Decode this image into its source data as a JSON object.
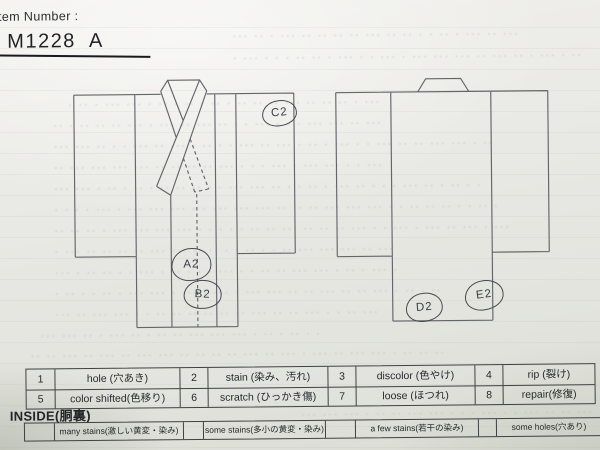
{
  "header": {
    "item_number_label": "tem Number :",
    "item_number_value": "M1228  A"
  },
  "diagram": {
    "marks": [
      {
        "id": "mark-c2",
        "label": "C2"
      },
      {
        "id": "mark-a2",
        "label": "A2"
      },
      {
        "id": "mark-b2",
        "label": "B2"
      },
      {
        "id": "mark-d2",
        "label": "D2"
      },
      {
        "id": "mark-e2",
        "label": "E2"
      }
    ]
  },
  "legend_table": {
    "rows": [
      [
        {
          "num": "1",
          "label": "hole (穴あき)"
        },
        {
          "num": "2",
          "label": "stain (染み、汚れ)"
        },
        {
          "num": "3",
          "label": "discolor (色やけ)"
        },
        {
          "num": "4",
          "label": "rip (裂け)"
        }
      ],
      [
        {
          "num": "5",
          "label": "color shifted(色移り)"
        },
        {
          "num": "6",
          "label": "scratch (ひっかき傷)"
        },
        {
          "num": "7",
          "label": "loose (ほつれ)"
        },
        {
          "num": "8",
          "label": "repair(修復)"
        }
      ]
    ]
  },
  "inside_section": {
    "title": "INSIDE(胴裏)",
    "options": [
      {
        "label": "many stains(激しい黄変・染み)"
      },
      {
        "label": "some stains(多小の黄変・染み)"
      },
      {
        "label": "a few stains(若干の染み)"
      },
      {
        "label": "some holes(穴あり)"
      }
    ]
  },
  "colors": {
    "paper": "#e9e9e4",
    "ink": "#26282c",
    "diagram_line": "#64656b",
    "handwriting": "#464952"
  }
}
